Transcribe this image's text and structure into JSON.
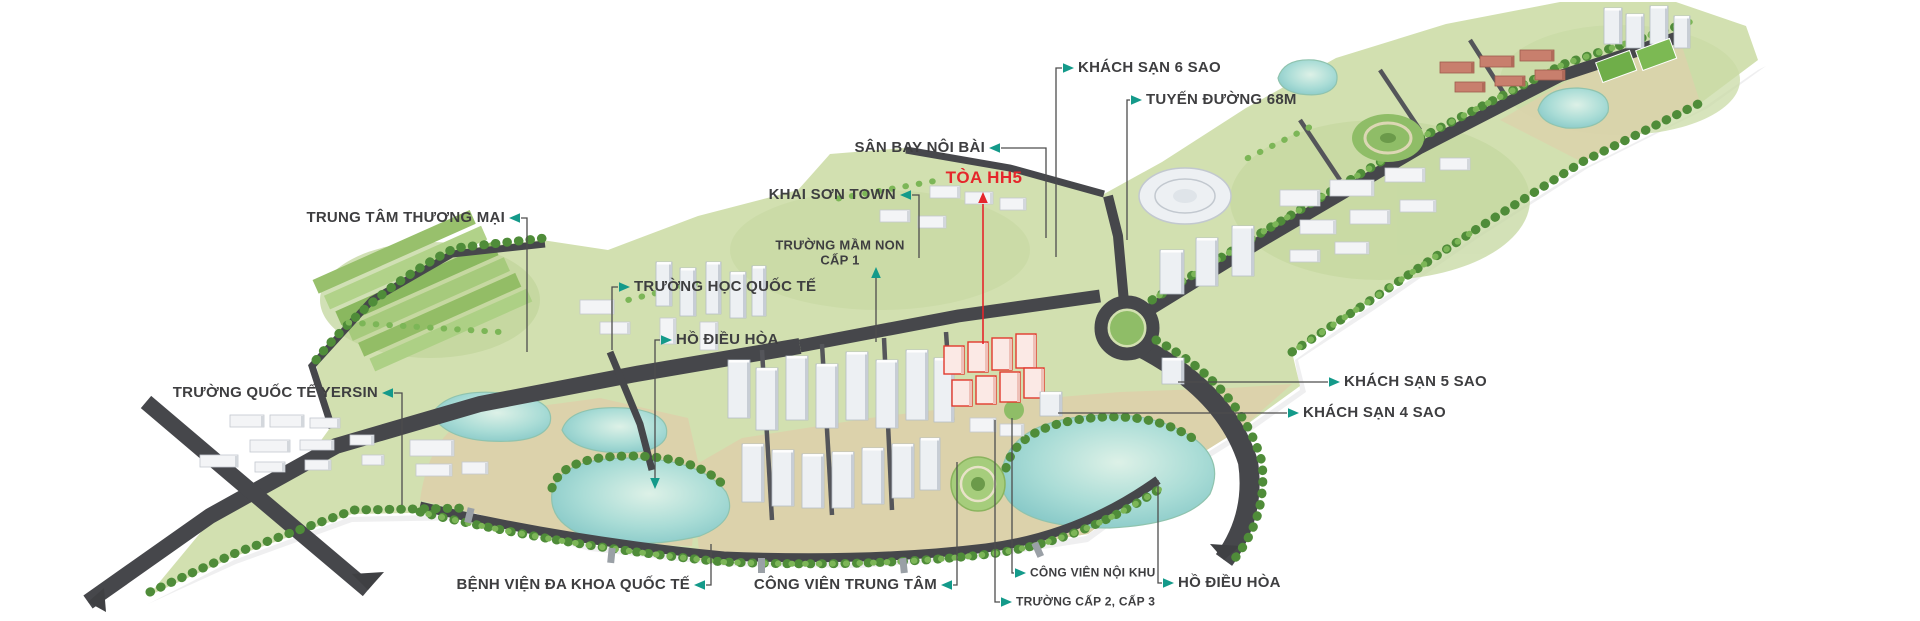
{
  "colors": {
    "accent_teal": "#149a8a",
    "highlight_red": "#e5262b",
    "label_text": "#3e3e40",
    "leader_line": "#4d4d4d",
    "water": "#8ecfcb",
    "land_green": "#d2e0b0",
    "road_dark": "#46474b"
  },
  "callouts": [
    {
      "id": "trung-tam-thuong-mai",
      "label": "TRUNG TÂM THƯƠNG MẠI"
    },
    {
      "id": "truong-hoc-quoc-te",
      "label": "TRƯỜNG HỌC QUỐC TẾ"
    },
    {
      "id": "ho-dieu-hoa-left",
      "label": "HỒ ĐIỀU HÒA"
    },
    {
      "id": "truong-quoc-te-yersin",
      "label": "TRƯỜNG QUỐC TẾ YERSIN"
    },
    {
      "id": "khai-son-town",
      "label": "KHAI SƠN TOWN"
    },
    {
      "id": "truong-mam-non-cap-1",
      "label": "TRƯỜNG MẦM NON",
      "label2": "CẤP 1"
    },
    {
      "id": "san-bay-noi-bai",
      "label": "SÂN BAY NỘI BÀI"
    },
    {
      "id": "toa-hh5",
      "label": "TÒA HH5",
      "highlight": true
    },
    {
      "id": "khach-san-6-sao",
      "label": "KHÁCH SẠN 6 SAO"
    },
    {
      "id": "tuyen-duong-68m",
      "label": "TUYẾN ĐƯỜNG 68M"
    },
    {
      "id": "khach-san-5-sao",
      "label": "KHÁCH SẠN 5 SAO"
    },
    {
      "id": "khach-san-4-sao",
      "label": "KHÁCH SẠN 4 SAO"
    },
    {
      "id": "benh-vien-da-khoa-quoc-te",
      "label": "BỆNH VIỆN ĐA KHOA QUỐC TẾ"
    },
    {
      "id": "cong-vien-trung-tam",
      "label": "CÔNG VIÊN TRUNG TÂM"
    },
    {
      "id": "cong-vien-noi-khu",
      "label": "CÔNG VIÊN NỘI KHU"
    },
    {
      "id": "truong-cap-2-cap-3",
      "label": "TRƯỜNG CẤP 2, CẤP 3"
    },
    {
      "id": "ho-dieu-hoa-right",
      "label": "HỒ ĐIỀU HÒA"
    }
  ]
}
